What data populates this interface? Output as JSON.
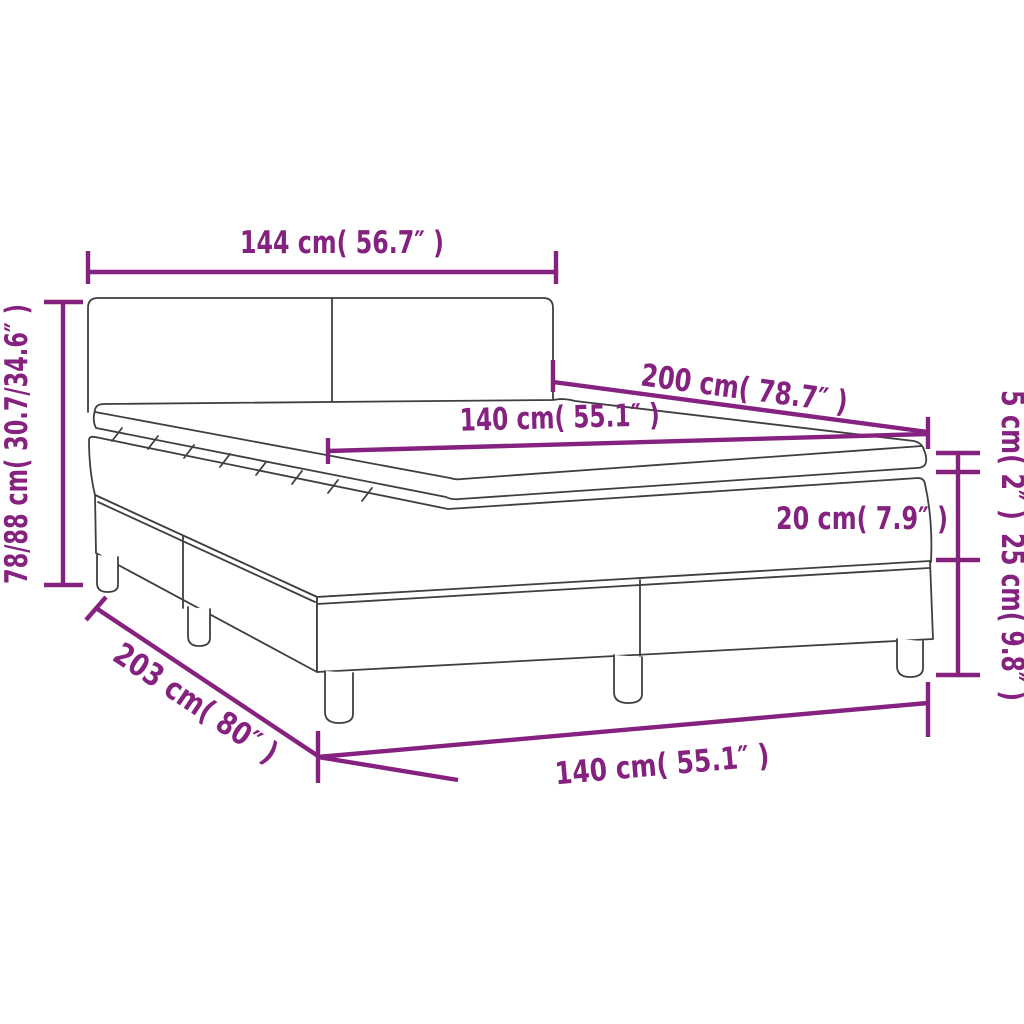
{
  "diagram": {
    "title": "box-spring-bed-dimension-diagram",
    "colors": {
      "dimension_accent": "#85217e",
      "outline": "#3f3f3f",
      "background": "#ffffff"
    },
    "dimensions": {
      "headboard_width": "144 cm( 56.7″ )",
      "total_height": "78/88 cm( 30.7/34.6″ )",
      "bed_length": "200 cm( 78.7″ )",
      "mattress_width": "140 cm( 55.1″ )",
      "topper_height": "5 cm( 2″ )",
      "mattress_height": "20 cm( 7.9″ )",
      "base_height": "25 cm( 9.8″ )",
      "base_length": "203 cm( 80″ )",
      "base_width": "140 cm( 55.1″ )"
    }
  }
}
